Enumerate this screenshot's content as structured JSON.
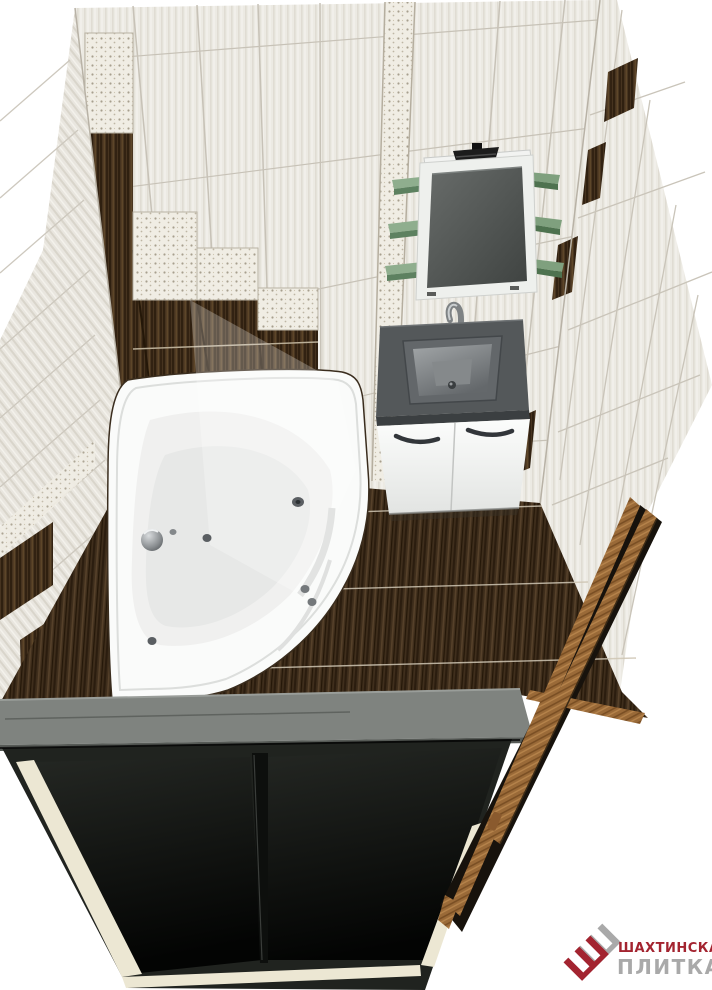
{
  "meta": {
    "kind": "3d-bathroom-design-render",
    "view": "top corner view of tiled bathroom"
  },
  "logo": {
    "line1": "ШАХТИНСКАЯ",
    "line2": "ПЛИТКА",
    "monogram": "Ш",
    "color_primary": "#a32430",
    "color_secondary": "#a9a9a9"
  },
  "colors": {
    "background": "#ffffff",
    "tile_light": "#eceae3",
    "tile_grout": "#c7c2b7",
    "tile_dark_wood": "#46331f",
    "ornament_tile": "#f0ede4",
    "floor_wood": "#3f2e1c",
    "floor_grout": "#cfc6b4",
    "mirror_frame": "#eef0ed",
    "mirror_glass": "#4a4e4c",
    "shelf_green": "#7fa07e",
    "counter_gray": "#54585a",
    "cabinet_white": "#fbfcfb",
    "ledge_gray": "#7f837f",
    "panel_black": "#121412",
    "panel_trim": "#ece7d3",
    "door_wood": "#9a6a38"
  },
  "scene": {
    "objects": [
      "back-wall",
      "left-wall",
      "right-wall",
      "decor-strip",
      "accent-staircase",
      "floor",
      "corner-bathtub",
      "vanity-cabinet",
      "sink",
      "faucet",
      "mirror",
      "mirror-lamp",
      "glass-shelves",
      "near-wall-ledge",
      "black-door-panels",
      "wood-door",
      "brand-logo"
    ]
  }
}
